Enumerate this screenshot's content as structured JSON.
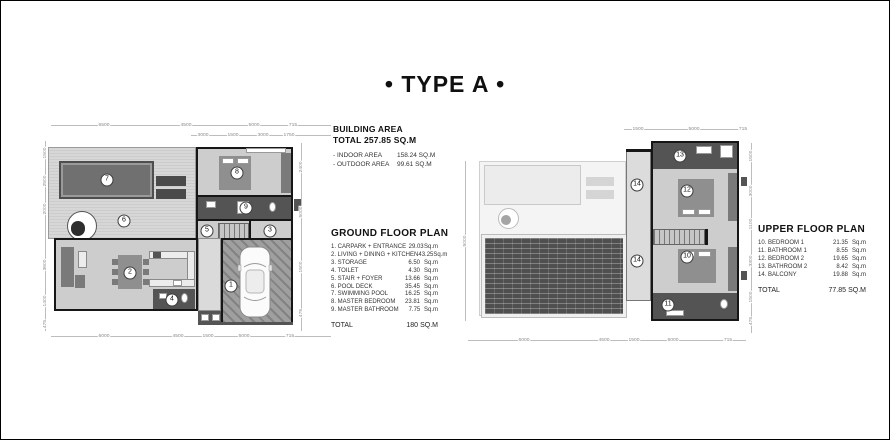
{
  "title": "• TYPE A •",
  "colors": {
    "ink": "#111111",
    "wall": "#161616",
    "pool": "#707070",
    "deck": "#d7d7d7"
  },
  "building_area": {
    "heading": "BUILDING AREA",
    "total_line": "TOTAL 257.85 SQ.M",
    "rows": [
      {
        "label": "- INDOOR AREA",
        "value": "158.24 SQ.M"
      },
      {
        "label": "- OUTDOOR AREA",
        "value": "99.61 SQ.M"
      }
    ]
  },
  "ground_floor": {
    "heading": "GROUND FLOOR PLAN",
    "rows": [
      {
        "label": "1. CARPARK + ENTRANCE",
        "value": "29.03",
        "unit": "Sq.m"
      },
      {
        "label": "2. LIVING + DINING + KITCHEN",
        "value": "43.25",
        "unit": "Sq.m"
      },
      {
        "label": "3. STORAGE",
        "value": "6.50",
        "unit": "Sq.m"
      },
      {
        "label": "4. TOILET",
        "value": "4.30",
        "unit": "Sq.m"
      },
      {
        "label": "5. STAIR + FOYER",
        "value": "13.66",
        "unit": "Sq.m"
      },
      {
        "label": "6. POOL DECK",
        "value": "35.45",
        "unit": "Sq.m"
      },
      {
        "label": "7. SWIMMING POOL",
        "value": "16.25",
        "unit": "Sq.m"
      },
      {
        "label": "8. MASTER BEDROOM",
        "value": "23.81",
        "unit": "Sq.m"
      },
      {
        "label": "9. MASTER BATHROOM",
        "value": "7.75",
        "unit": "Sq.m"
      }
    ],
    "total_label": "TOTAL",
    "total_value": "180",
    "total_unit": "SQ.M"
  },
  "upper_floor": {
    "heading": "UPPER FLOOR PLAN",
    "rows": [
      {
        "label": "10. BEDROOM 1",
        "value": "21.35",
        "unit": "Sq.m"
      },
      {
        "label": "11. BATHROOM 1",
        "value": "8.55",
        "unit": "Sq.m"
      },
      {
        "label": "12. BEDROOM 2",
        "value": "19.65",
        "unit": "Sq.m"
      },
      {
        "label": "13. BATHROOM 2",
        "value": "8.42",
        "unit": "Sq.m"
      },
      {
        "label": "14. BALCONY",
        "value": "19.88",
        "unit": "Sq.m"
      }
    ],
    "total_label": "TOTAL",
    "total_value": "77.85",
    "total_unit": "SQ.M"
  },
  "ground_plan": {
    "room_numbers": [
      "1",
      "2",
      "3",
      "4",
      "5",
      "6",
      "7",
      "8",
      "9"
    ],
    "dims_top": [
      "6500",
      "4500",
      "5000",
      "715"
    ],
    "dims_top2": [
      "3000",
      "1500",
      "3000",
      "1750"
    ],
    "dims_bottom": [
      "6000",
      "4500",
      "1500",
      "5000",
      "715"
    ],
    "dims_left": [
      "1500",
      "2500",
      "2000",
      "3600",
      "1400",
      "475"
    ],
    "dims_right": [
      "2400",
      "5000",
      "1500",
      "475"
    ]
  },
  "upper_plan": {
    "room_numbers": [
      "10",
      "11",
      "12",
      "13",
      "14"
    ],
    "dims_top": [
      "1500",
      "5000",
      "715"
    ],
    "dims_bottom": [
      "6000",
      "4500",
      "1500",
      "5000",
      "715"
    ],
    "dims_right": [
      "1500",
      "3000",
      "1100",
      "3300",
      "1500",
      "475"
    ],
    "dims_left": [
      "5000"
    ]
  }
}
